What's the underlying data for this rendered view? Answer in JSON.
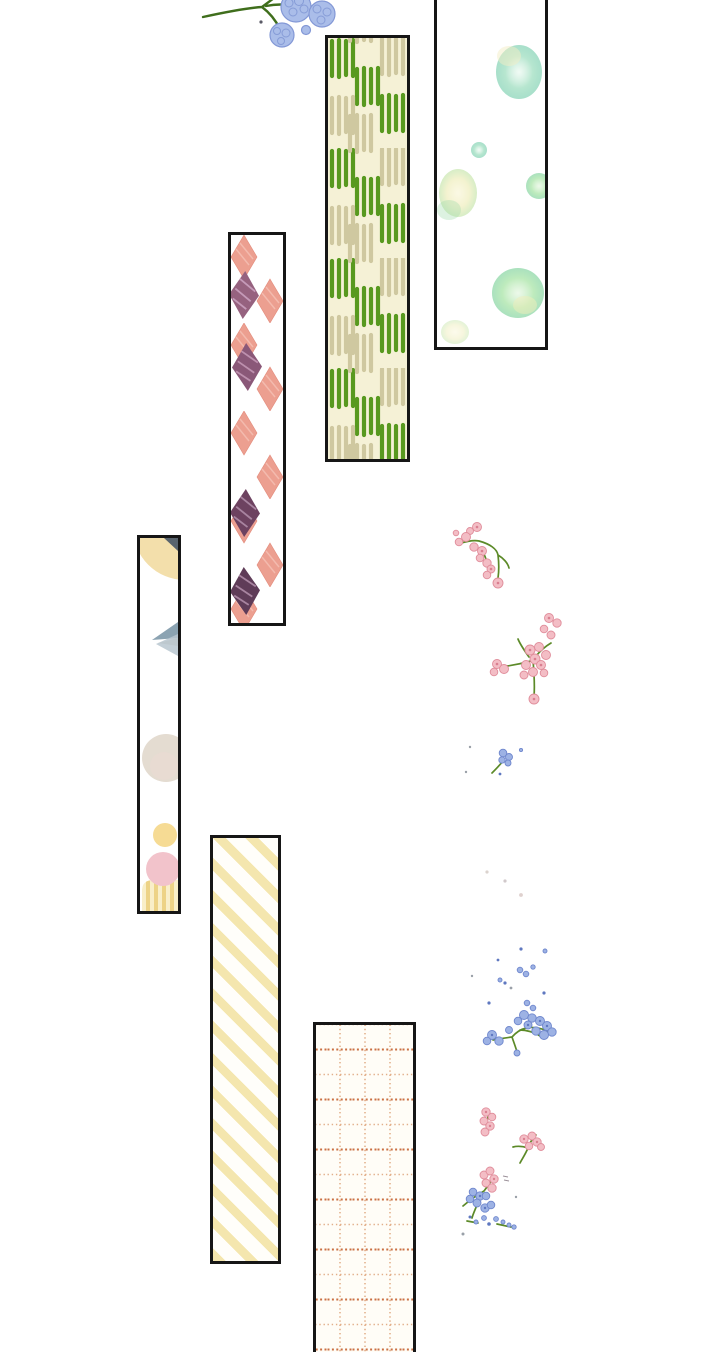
{
  "page": {
    "width": 720,
    "height": 1352,
    "background": "#ffffff",
    "kind": "decorative comic transition panel",
    "visible_text": ""
  },
  "palette": {
    "tape_border": "#161616",
    "green_bright": "#58991f",
    "green_pale": "#cfc8a0",
    "cream": "#f5f1d6",
    "watercolor_green": "#8ed7a8",
    "watercolor_teal": "#83d2b4",
    "watercolor_yellow": "#eeedbb",
    "argyle_pink": "#ec9f90",
    "argyle_mauve": "#8a5878",
    "pastel_cream": "#f3dfab",
    "pastel_slate": "#59646e",
    "pastel_gray_blue": "#8ba3b2",
    "pastel_beige": "#e4dcd1",
    "pastel_yellow": "#f6db94",
    "pastel_pink": "#f2c3cb",
    "stripe_yellow": "#f4e6ae",
    "grid_orange_light": "#d89565",
    "grid_orange_strong": "#c4602f",
    "blossom_pink": "#f3bdc5",
    "blossom_blue": "#9db2e4",
    "hydrangea_blue": "#aabde9",
    "stem_green": "#5c8a28"
  },
  "tapes": [
    {
      "name": "green-dash-tape",
      "pattern": "checkered vertical brush dashes",
      "background": "#f5f1d6",
      "accents": [
        "#58991f",
        "#cfc8a0"
      ],
      "position": "upper-center"
    },
    {
      "name": "watercolor-dot-tape",
      "pattern": "green watercolor dots",
      "background": "#ffffff",
      "accents": [
        "#8ed7a8",
        "#83d2b4",
        "#eeedbb"
      ],
      "position": "upper-right, cut at top"
    },
    {
      "name": "pink-argyle-tape",
      "pattern": "argyle diamonds with dark hatched diamonds",
      "background": "#ffffff",
      "accents": [
        "#ec9f90",
        "#8a5878"
      ],
      "position": "upper-left-center"
    },
    {
      "name": "pastel-shape-tape",
      "pattern": "pastel abstract shapes",
      "background": "#ffffff",
      "accents": [
        "#f3dfab",
        "#8ba3b2",
        "#e4dcd1",
        "#f6db94",
        "#f2c3cb"
      ],
      "position": "middle-left"
    },
    {
      "name": "yellow-stripe-tape",
      "pattern": "pale yellow diagonal stripes",
      "background": "#fffefa",
      "accents": [
        "#f4e6ae"
      ],
      "position": "lower-left-center"
    },
    {
      "name": "orange-grid-tape",
      "pattern": "dotted orange grid",
      "background": "#fffdf7",
      "accents": [
        "#d89565",
        "#c4602f"
      ],
      "position": "bottom-center, cut at bottom"
    }
  ],
  "flowers": [
    {
      "name": "hydrangea-flower-cluster",
      "color": "#aabde9",
      "stem": "#3f6e1c",
      "position": "top-center, cut at top"
    },
    {
      "name": "pink-sprig-upper",
      "color": "#f3bdc5",
      "stem": "#5c8a28",
      "position": "right, y≈520-590"
    },
    {
      "name": "pink-flower-cluster",
      "color": "#f3bdc5",
      "stem": "#5c8a28",
      "position": "right, y≈610-700"
    },
    {
      "name": "blue-sprig-small",
      "color": "#9db2e4",
      "stem": "#5c8a28",
      "position": "right, y≈745-775"
    },
    {
      "name": "faint-specks",
      "color": "#d5ccc6",
      "position": "right, y≈870-895"
    },
    {
      "name": "blue-flower-cluster",
      "color": "#9db2e4",
      "stem": "#5c8a28",
      "position": "right, y≈945-1055"
    },
    {
      "name": "pink-chain",
      "color": "#f3bdc5",
      "position": "right, y≈1108-1133"
    },
    {
      "name": "pink-sprig-lower",
      "color": "#f3bdc5",
      "stem": "#5c8a28",
      "position": "right, y≈1135-1163"
    },
    {
      "name": "mixed-blue-pink-cluster",
      "colors": [
        "#9db2e4",
        "#f3bdc5"
      ],
      "stem": "#5c8a28",
      "position": "right, y≈1170-1240"
    }
  ]
}
